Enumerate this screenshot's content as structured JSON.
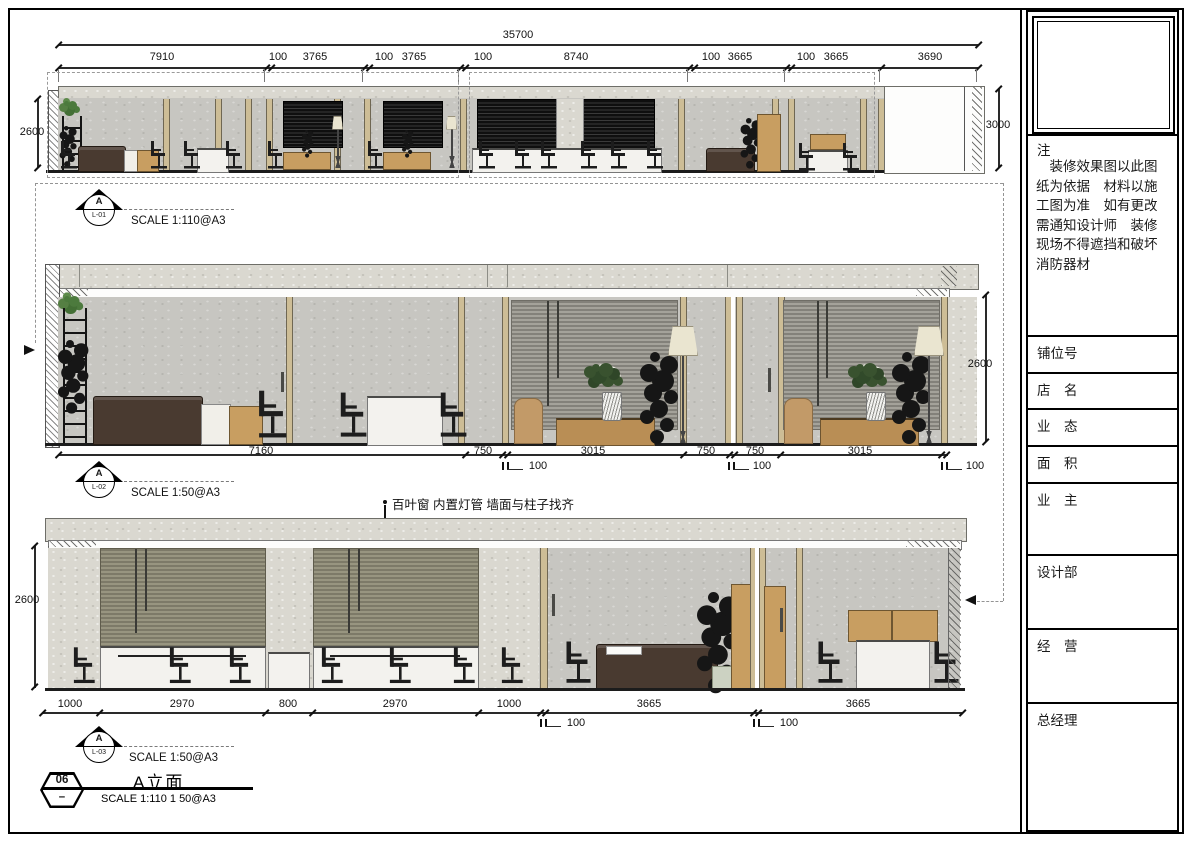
{
  "title_block": {
    "note_title": "注",
    "note_body": "装修效果图以此图纸为依据　材料以施工图为准　如有更改需通知设计师　装修现场不得遮挡和破坏消防器材",
    "rows": [
      "铺位号",
      "店　名",
      "业　态",
      "面　积",
      "业　主",
      "设计部",
      "经　营",
      "总经理"
    ]
  },
  "drawing": {
    "sheet_number": "06",
    "sheet_dash": "–",
    "sheet_title": "A立面",
    "sheet_scale": "SCALE 1:110 1  50@A3",
    "annotation": "百叶窗 内置灯管 墙面与柱子找齐",
    "views": [
      {
        "label": "A",
        "id": "L-01",
        "scale": "SCALE 1:110@A3"
      },
      {
        "label": "A",
        "id": "L-02",
        "scale": "SCALE 1:50@A3"
      },
      {
        "label": "A",
        "id": "L-03",
        "scale": "SCALE 1:50@A3"
      }
    ],
    "elevation1": {
      "overall": "35700",
      "top_dims": [
        "7910",
        "100",
        "3765",
        "100",
        "3765",
        "100",
        "8740",
        "100",
        "3665",
        "100",
        "3665",
        "3690"
      ],
      "left_height": "2600",
      "right_height": "3000"
    },
    "elevation2": {
      "bottom_dims": [
        "7160",
        "750",
        "3015",
        "750",
        "750",
        "3015"
      ],
      "glass_dims": [
        "100",
        "100",
        "100"
      ],
      "right_height": "2600"
    },
    "elevation3": {
      "bottom_dims": [
        "1000",
        "2970",
        "800",
        "2970",
        "1000",
        "3665",
        "3665"
      ],
      "glass_dims": [
        "100",
        "100"
      ],
      "left_height": "2600"
    }
  }
}
